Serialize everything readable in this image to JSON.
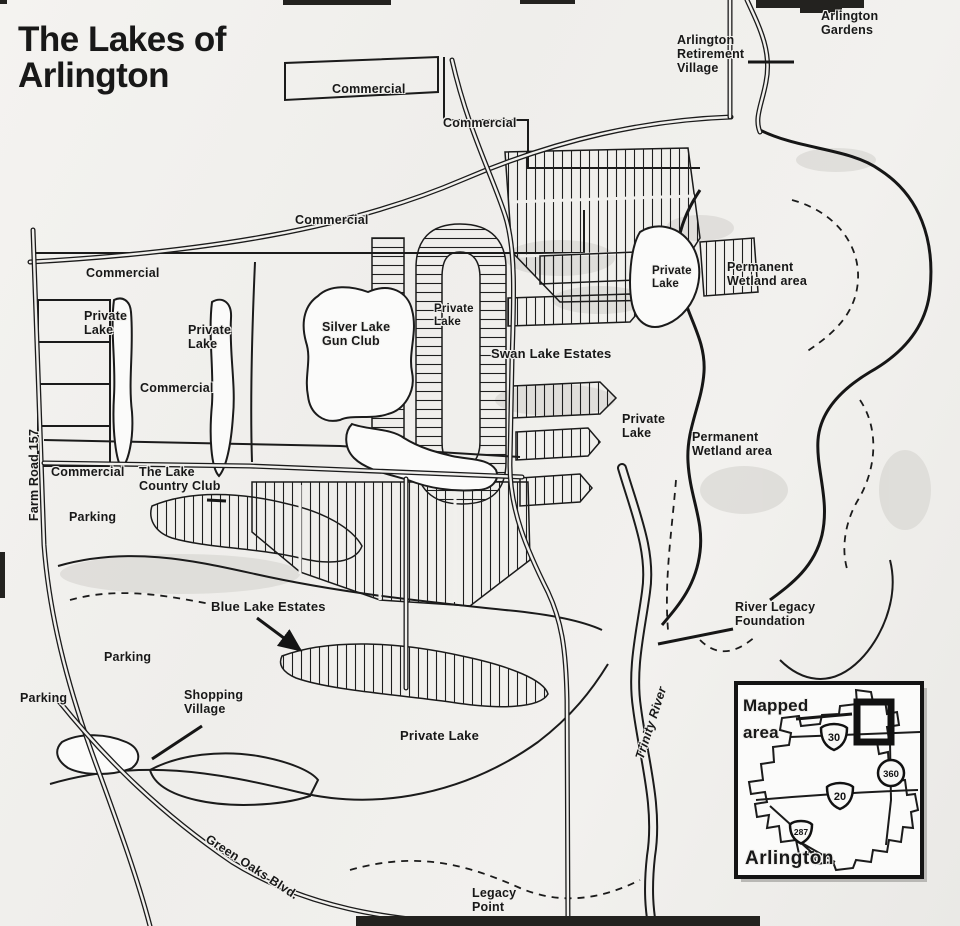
{
  "labels": {
    "title": "The Lakes of\nArlington",
    "commercial_top_left": "Commercial",
    "commercial_top_right": "Commercial",
    "arlington_retirement_village": "Arlington\nRetirement\nVillage",
    "arlington_gardens": "Arlington\nGardens",
    "commercial_mid": "Commercial",
    "commercial_west": "Commercial",
    "private_lake_west_1": "Private\nLake",
    "private_lake_west_2": "Private\nLake",
    "commercial_west_2": "Commercial",
    "silver_lake_gun_club": "Silver Lake\nGun Club",
    "private_lake_center": "Private\nLake",
    "swan_lake_estates": "Swan Lake Estates",
    "private_lake_northeast": "Private\nLake",
    "permanent_wetland_north": "Permanent\nWetland area",
    "private_lake_east": "Private\nLake",
    "permanent_wetland_south": "Permanent\nWetland area",
    "farm_road_157": "Farm Road 157",
    "commercial_southwest": "Commercial",
    "lake_country_club": "The Lake\nCountry Club",
    "parking_1": "Parking",
    "blue_lake_estates": "Blue Lake Estates",
    "parking_2": "Parking",
    "parking_3": "Parking",
    "shopping_village": "Shopping\nVillage",
    "private_lake_south": "Private Lake",
    "trinity_river": "Trinity River",
    "river_legacy_foundation": "River Legacy\nFoundation",
    "green_oaks_blvd": "Green Oaks Blvd.",
    "legacy_point": "Legacy\nPoint"
  },
  "inset": {
    "mapped_area": "Mapped\narea",
    "city": "Arlington",
    "shields": {
      "i30": "30",
      "loop360": "360",
      "i20": "20",
      "us287": "287"
    }
  },
  "colors": {
    "ink": "#181818",
    "paper": "#f1f0ed"
  }
}
